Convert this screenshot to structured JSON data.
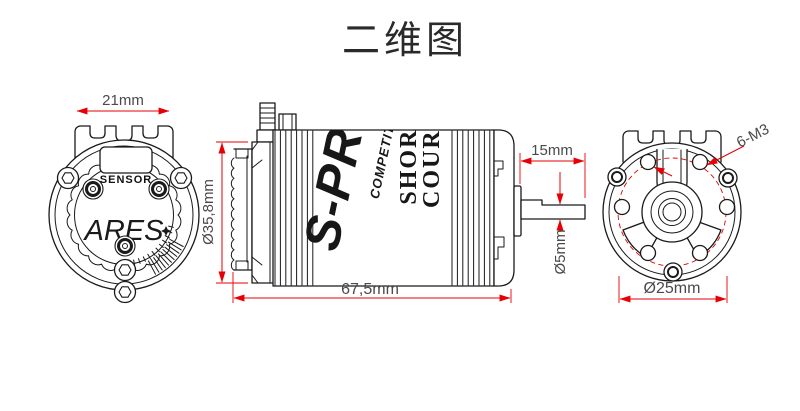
{
  "title": "二维图",
  "colors": {
    "line": "#1a1a1a",
    "dimension_red": "#e60005",
    "dim_text": "#4a4a4a"
  },
  "rear_view": {
    "dim_tab_width": "21mm",
    "sensor_label": "SENSOR",
    "brand": "ARES"
  },
  "side_view": {
    "dim_diameter": "Ø35,8mm",
    "dim_length": "67,5mm",
    "dim_shaft_length": "15mm",
    "dim_shaft_diameter": "Ø5mm",
    "marking_brand": "S-PRO",
    "marking_series": "COMPETITION",
    "marking_type_line1": "SHORT",
    "marking_type_line2": "COURSE"
  },
  "front_view": {
    "dim_mount_holes": "6-M3",
    "dim_bolt_circle": "Ø25mm"
  }
}
